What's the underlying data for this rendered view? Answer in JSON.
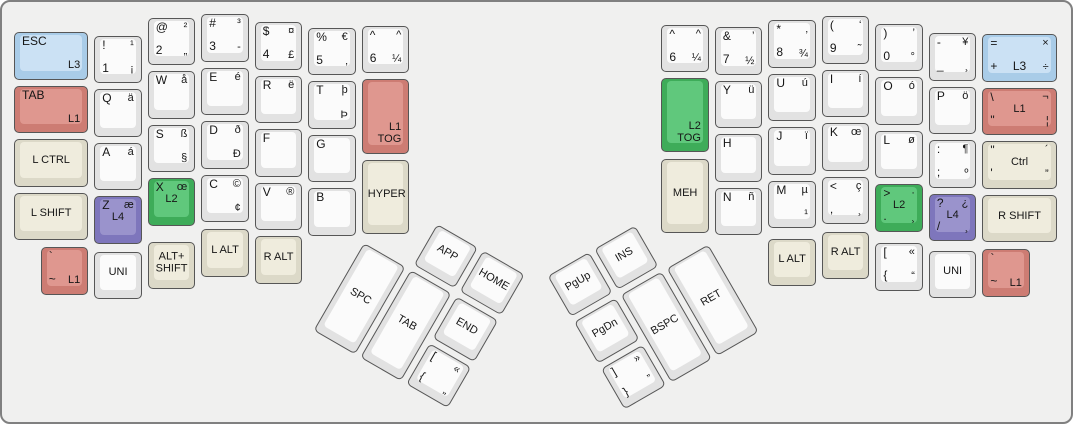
{
  "palette": {
    "white": {
      "outer": "#e2e2e2",
      "inner": "#fbfbfb"
    },
    "mod": {
      "outer": "#dcd9c8",
      "inner": "#efecdd"
    },
    "red": {
      "outer": "#cd7c73",
      "inner": "#df978f"
    },
    "blue": {
      "outer": "#a9cce8",
      "inner": "#cbe1f4"
    },
    "green": {
      "outer": "#3eac59",
      "inner": "#60c87c"
    },
    "purple": {
      "outer": "#7e76bc",
      "inner": "#9a93cc"
    }
  },
  "keyboard": {
    "left_main": {
      "origin": [
        12,
        12
      ],
      "rotation_deg": 0,
      "keys": [
        {
          "n": "esc-l3",
          "x": 0,
          "y": 0.34,
          "w": 1.5,
          "c": "blue",
          "tl": "ESC",
          "br": "L3"
        },
        {
          "n": "1",
          "x": 1.5,
          "y": 0.41,
          "tl": "!",
          "tr": "¹",
          "bl": "1",
          "br": "¡"
        },
        {
          "n": "2",
          "x": 2.5,
          "y": 0.07,
          "tl": "@",
          "tr": "²",
          "bl": "2",
          "br": "„"
        },
        {
          "n": "3",
          "x": 3.5,
          "y": 0,
          "tl": "#",
          "tr": "³",
          "bl": "3",
          "br": "-"
        },
        {
          "n": "4",
          "x": 4.5,
          "y": 0.15,
          "tl": "$",
          "tr": "¤",
          "bl": "4",
          "br": "£"
        },
        {
          "n": "5",
          "x": 5.5,
          "y": 0.26,
          "tl": "%",
          "tr": "€",
          "bl": "5",
          "br": "‚"
        },
        {
          "n": "6-left",
          "x": 6.5,
          "y": 0.22,
          "tl": "^",
          "tr": "^",
          "bl": "6",
          "br": "¼"
        },
        {
          "n": "tab-l1",
          "x": 0,
          "y": 1.34,
          "w": 1.5,
          "c": "red",
          "tl": "TAB",
          "br": "L1"
        },
        {
          "n": "q",
          "x": 1.5,
          "y": 1.41,
          "tl": "Q",
          "tr": "ä"
        },
        {
          "n": "w",
          "x": 2.5,
          "y": 1.07,
          "tl": "W",
          "tr": "å"
        },
        {
          "n": "e",
          "x": 3.5,
          "y": 1,
          "tl": "E",
          "tr": "é"
        },
        {
          "n": "r",
          "x": 4.5,
          "y": 1.15,
          "tl": "R",
          "tr": "ë"
        },
        {
          "n": "t",
          "x": 5.5,
          "y": 1.26,
          "tl": "T",
          "tr": "þ",
          "br": "Þ"
        },
        {
          "n": "l1-tog",
          "x": 6.5,
          "y": 1.22,
          "h": 1.5,
          "c": "red",
          "br": "L1\nTOG"
        },
        {
          "n": "lctrl",
          "x": 0,
          "y": 2.34,
          "w": 1.5,
          "c": "mod",
          "ce": "L CTRL"
        },
        {
          "n": "a",
          "x": 1.5,
          "y": 2.41,
          "tl": "A",
          "tr": "á"
        },
        {
          "n": "s",
          "x": 2.5,
          "y": 2.07,
          "tl": "S",
          "tr": "ß",
          "br": "§"
        },
        {
          "n": "d",
          "x": 3.5,
          "y": 2,
          "tl": "D",
          "tr": "ð",
          "br": "Ð"
        },
        {
          "n": "f",
          "x": 4.5,
          "y": 2.15,
          "tl": "F"
        },
        {
          "n": "g",
          "x": 5.5,
          "y": 2.26,
          "tl": "G"
        },
        {
          "n": "hyper",
          "x": 6.5,
          "y": 2.72,
          "h": 1.5,
          "c": "mod",
          "ce": "HYPER"
        },
        {
          "n": "lshift",
          "x": 0,
          "y": 3.34,
          "w": 1.5,
          "c": "mod",
          "ce": "L SHIFT"
        },
        {
          "n": "z-l4",
          "x": 1.5,
          "y": 3.41,
          "c": "purple",
          "tl": "Z",
          "tr": "æ",
          "ce": "L4"
        },
        {
          "n": "x-l2",
          "x": 2.5,
          "y": 3.07,
          "c": "green",
          "tl": "X",
          "tr": "œ",
          "ce": "L2"
        },
        {
          "n": "c",
          "x": 3.5,
          "y": 3,
          "tl": "C",
          "tr": "©",
          "br": "¢"
        },
        {
          "n": "v",
          "x": 4.5,
          "y": 3.15,
          "tl": "V",
          "tr": "®"
        },
        {
          "n": "b",
          "x": 5.5,
          "y": 3.26,
          "tl": "B"
        },
        {
          "n": "grave-l1-left",
          "x": 0.5,
          "y": 4.36,
          "c": "red",
          "tl": "`",
          "bl": "~",
          "br": "L1"
        },
        {
          "n": "uni-left",
          "x": 1.5,
          "y": 4.44,
          "ce": "UNI"
        },
        {
          "n": "alt-shift",
          "x": 2.5,
          "y": 4.26,
          "c": "mod",
          "ce": "ALT+\nSHIFT"
        },
        {
          "n": "lalt-left",
          "x": 3.5,
          "y": 4.02,
          "c": "mod",
          "ce": "L ALT"
        },
        {
          "n": "ralt-left",
          "x": 4.5,
          "y": 4.15,
          "c": "mod",
          "ce": "R ALT"
        }
      ]
    },
    "left_thumb": {
      "origin": [
        362,
        241
      ],
      "rotation_deg": 30,
      "keys": [
        {
          "n": "app",
          "x": 1,
          "y": -1,
          "ce": "APP"
        },
        {
          "n": "home",
          "x": 2,
          "y": -1,
          "ce": "HOME"
        },
        {
          "n": "spc",
          "x": 0,
          "y": 0,
          "h": 2,
          "ce": "SPC"
        },
        {
          "n": "tab-thumb",
          "x": 1,
          "y": 0,
          "h": 2,
          "ce": "TAB"
        },
        {
          "n": "end",
          "x": 2,
          "y": 0,
          "ce": "END"
        },
        {
          "n": "lbracket-thumb",
          "x": 2,
          "y": 1,
          "tl": "[",
          "tr": "«",
          "bl": "{",
          "br": "„"
        }
      ]
    },
    "right_main": {
      "origin": [
        12,
        12
      ],
      "rotation_deg": 0,
      "keys": [
        {
          "n": "6-right",
          "x": 12.1,
          "y": 0.2,
          "tl": "^",
          "tr": "^",
          "bl": "6",
          "br": "¼"
        },
        {
          "n": "7",
          "x": 13.1,
          "y": 0.25,
          "tl": "&",
          "tr": "’",
          "bl": "7",
          "br": "½"
        },
        {
          "n": "8",
          "x": 14.1,
          "y": 0.12,
          "tl": "*",
          "tr": "‚",
          "bl": "8",
          "br": "¾"
        },
        {
          "n": "9",
          "x": 15.1,
          "y": 0.04,
          "tl": "(",
          "tr": "‘",
          "bl": "9",
          "br": "˜"
        },
        {
          "n": "0",
          "x": 16.1,
          "y": 0.18,
          "tl": ")",
          "tr": "’",
          "bl": "0",
          "br": "°"
        },
        {
          "n": "minus",
          "x": 17.1,
          "y": 0.36,
          "tl": "-",
          "tr": "¥",
          "bl": "_",
          "br": "¸"
        },
        {
          "n": "equals-l3",
          "x": 18.1,
          "y": 0.38,
          "w": 1.5,
          "c": "blue",
          "tl": "=",
          "tr": "×",
          "bl": "+",
          "bc": "L3",
          "br": "÷"
        },
        {
          "n": "l2-tog",
          "x": 12.1,
          "y": 1.2,
          "h": 1.5,
          "c": "green",
          "br": "L2\nTOG"
        },
        {
          "n": "y",
          "x": 13.1,
          "y": 1.25,
          "tl": "Y",
          "tr": "ü"
        },
        {
          "n": "u",
          "x": 14.1,
          "y": 1.12,
          "tl": "U",
          "tr": "ú"
        },
        {
          "n": "i",
          "x": 15.1,
          "y": 1.04,
          "tl": "I",
          "tr": "í"
        },
        {
          "n": "o",
          "x": 16.1,
          "y": 1.18,
          "tl": "O",
          "tr": "ó"
        },
        {
          "n": "p",
          "x": 17.1,
          "y": 1.36,
          "tl": "P",
          "tr": "ö"
        },
        {
          "n": "backslash-l1",
          "x": 18.1,
          "y": 1.38,
          "w": 1.5,
          "c": "red",
          "tl": "\\",
          "tr": "¬",
          "bl": "\"",
          "ce": "L1",
          "br": "¦"
        },
        {
          "n": "meh",
          "x": 12.1,
          "y": 2.7,
          "h": 1.5,
          "c": "mod",
          "ce": "MEH"
        },
        {
          "n": "h",
          "x": 13.1,
          "y": 2.25,
          "tl": "H"
        },
        {
          "n": "j",
          "x": 14.1,
          "y": 2.12,
          "tl": "J",
          "tr": "ï"
        },
        {
          "n": "k",
          "x": 15.1,
          "y": 2.04,
          "tl": "K",
          "tr": "œ"
        },
        {
          "n": "l",
          "x": 16.1,
          "y": 2.18,
          "tl": "L",
          "tr": "ø"
        },
        {
          "n": "semicolon",
          "x": 17.1,
          "y": 2.36,
          "tl": ":",
          "tr": "¶",
          "bl": ";",
          "br": "º"
        },
        {
          "n": "quote-ctrl",
          "x": 18.1,
          "y": 2.38,
          "w": 1.5,
          "c": "mod",
          "tl": "\"",
          "tr": "´",
          "bl": "'",
          "ce": "Ctrl",
          "br": "”"
        },
        {
          "n": "n",
          "x": 13.1,
          "y": 3.25,
          "tl": "N",
          "tr": "ñ"
        },
        {
          "n": "m",
          "x": 14.1,
          "y": 3.12,
          "tl": "M",
          "tr": "µ",
          "br": "¹"
        },
        {
          "n": "comma",
          "x": 15.1,
          "y": 3.04,
          "tl": "<",
          "tr": "ç",
          "bl": ",",
          "br": "¸"
        },
        {
          "n": "period-l2",
          "x": 16.1,
          "y": 3.18,
          "c": "green",
          "tl": ">",
          "tr": "·",
          "bl": ".",
          "ce": "L2",
          "br": "¸"
        },
        {
          "n": "slash-l4",
          "x": 17.1,
          "y": 3.36,
          "c": "purple",
          "tl": "?",
          "tr": "¿",
          "bl": "/",
          "ce": "L4",
          "br": "¸"
        },
        {
          "n": "rshift",
          "x": 18.1,
          "y": 3.38,
          "w": 1.5,
          "c": "mod",
          "ce": "R SHIFT"
        },
        {
          "n": "lalt-right",
          "x": 14.1,
          "y": 4.2,
          "c": "mod",
          "ce": "L ALT"
        },
        {
          "n": "ralt-right",
          "x": 15.1,
          "y": 4.07,
          "c": "mod",
          "ce": "R ALT"
        },
        {
          "n": "lbracket-right",
          "x": 16.1,
          "y": 4.28,
          "tl": "[",
          "tr": "«",
          "bl": "{",
          "br": "“"
        },
        {
          "n": "uni-right",
          "x": 17.1,
          "y": 4.42,
          "ce": "UNI"
        },
        {
          "n": "grave-l1-right",
          "x": 18.1,
          "y": 4.4,
          "c": "red",
          "tl": "`",
          "bl": "~",
          "br": "L1"
        }
      ]
    },
    "right_thumb": {
      "origin": [
        572,
        320
      ],
      "rotation_deg": -30,
      "keys": [
        {
          "n": "pgup",
          "x": 0,
          "y": -1,
          "ce": "PgUp"
        },
        {
          "n": "ins",
          "x": 1,
          "y": -1,
          "ce": "INS"
        },
        {
          "n": "pgdn",
          "x": 0,
          "y": 0,
          "ce": "PgDn"
        },
        {
          "n": "bspc",
          "x": 1,
          "y": 0,
          "h": 2,
          "ce": "BSPC"
        },
        {
          "n": "ret",
          "x": 2,
          "y": 0,
          "h": 2,
          "ce": "RET"
        },
        {
          "n": "rbracket-thumb",
          "x": 0,
          "y": 1,
          "tl": "]",
          "tr": "»",
          "bl": "}",
          "br": "”"
        }
      ]
    }
  }
}
